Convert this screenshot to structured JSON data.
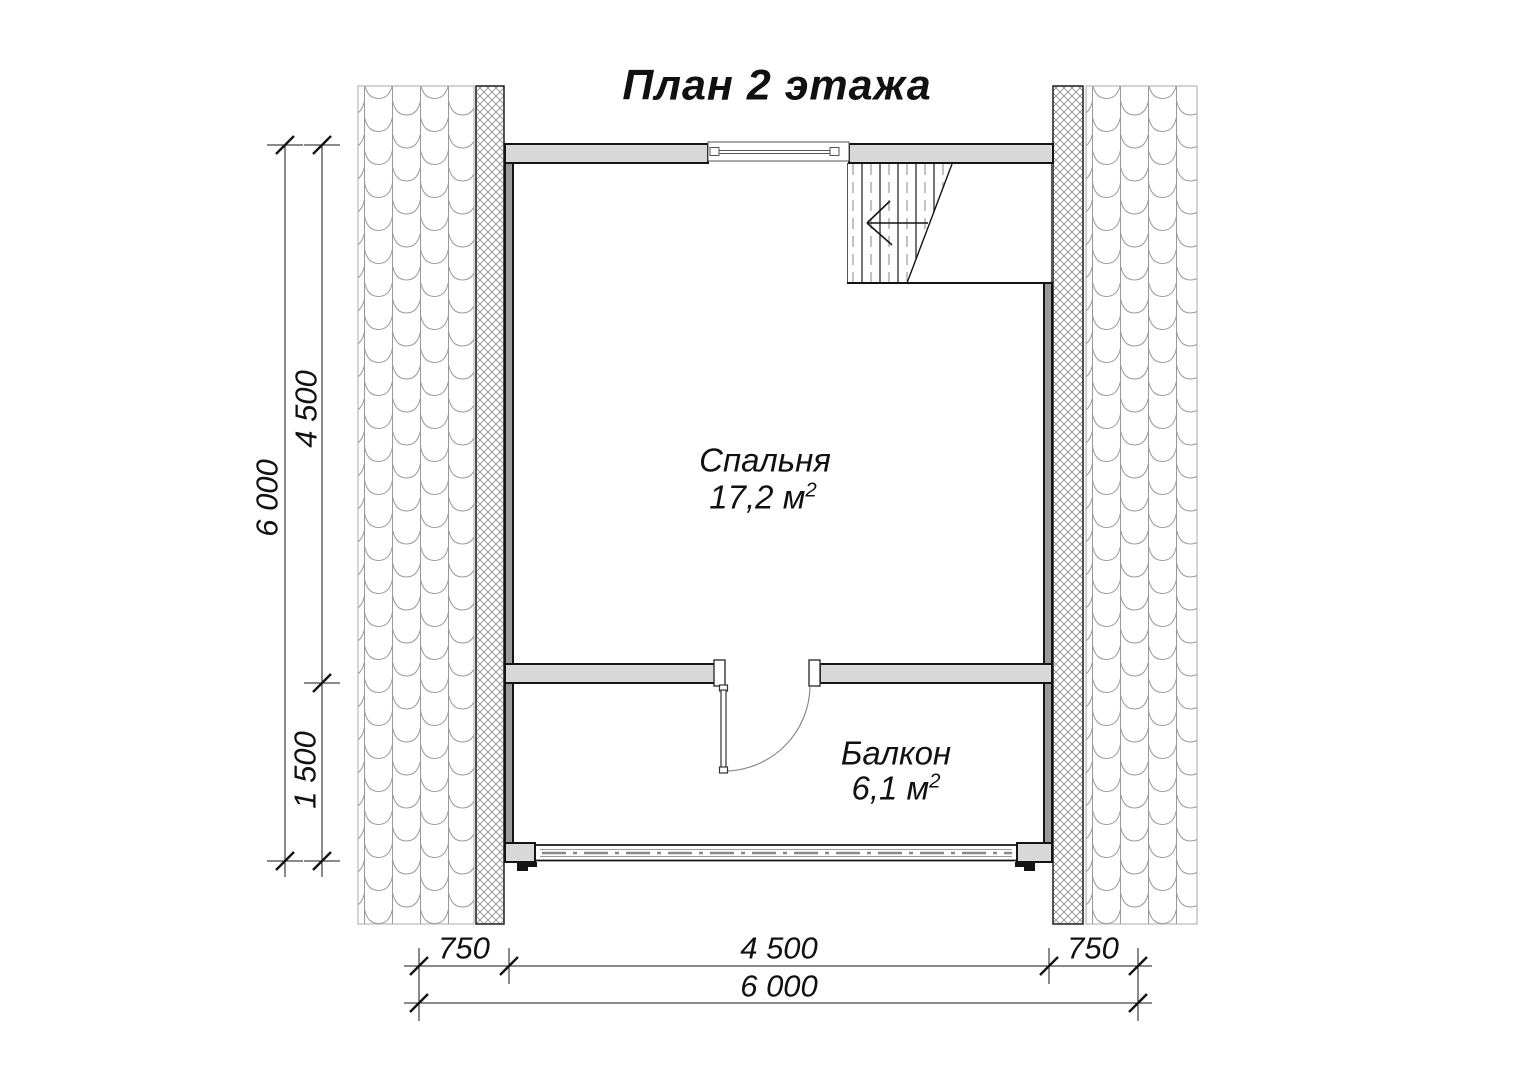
{
  "title": "План 2 этажа",
  "rooms": [
    {
      "name": "Спальня",
      "area": "17,2 м",
      "area_sup": "2"
    },
    {
      "name": "Балкон",
      "area": "6,1 м",
      "area_sup": "2"
    }
  ],
  "dimensions": {
    "left": [
      {
        "label": "6 000"
      },
      {
        "label": "4 500"
      },
      {
        "label": "1 500"
      }
    ],
    "bottom": [
      {
        "label": "750"
      },
      {
        "label": "4 500"
      },
      {
        "label": "750"
      },
      {
        "label": "6 000"
      }
    ]
  },
  "colors": {
    "wall_fill": "#d8d8d8",
    "line": "#141414",
    "hatch": "#8f8f8f",
    "tile": "#9a9a9a"
  }
}
